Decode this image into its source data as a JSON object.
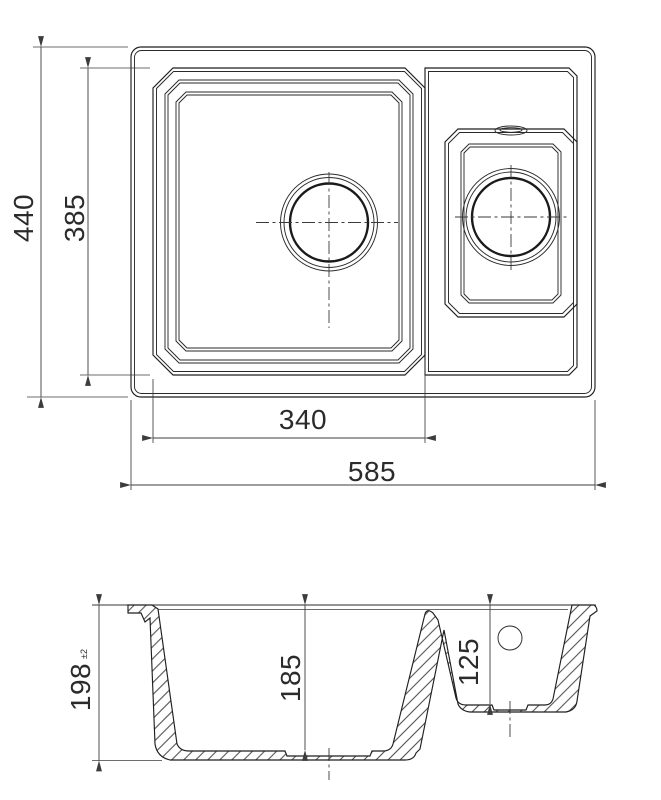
{
  "drawing": {
    "type": "technical-drawing",
    "subject": "kitchen sink with one and a half bowls, top view and cross-section",
    "colors": {
      "background": "#ffffff",
      "line": "#1f1f1f",
      "dimension": "#3c3c3c",
      "text": "#2b2b2b"
    },
    "plan": {
      "dim_overall_width": "585",
      "dim_overall_depth": "440",
      "dim_inner_depth": "385",
      "dim_main_bowl_width": "340"
    },
    "section": {
      "dim_overall_height": "198",
      "dim_height_tolerance": "±2",
      "dim_main_bowl_depth": "185",
      "dim_small_bowl_depth": "125"
    }
  }
}
